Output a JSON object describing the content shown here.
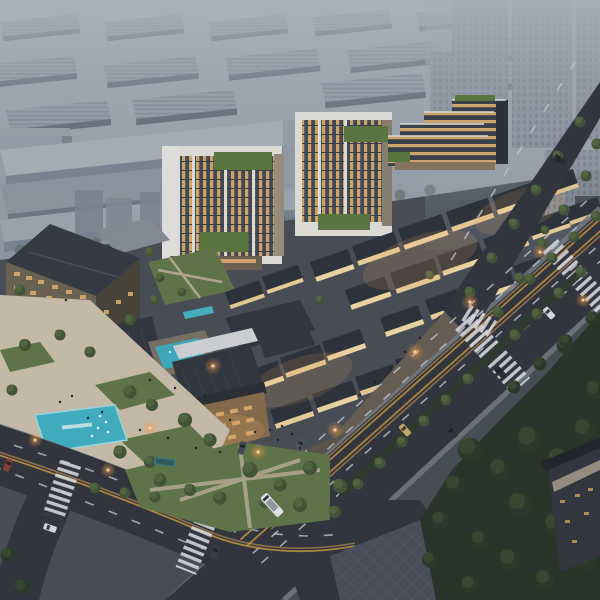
{
  "scene": {
    "type": "architectural-aerial-rendering",
    "time_of_day": "dusk",
    "description": "Aerial dusk rendering of a mixed-use development: two lit mid-rise office towers with rooftop gardens, a terraced office building, a hotel block, a low-rise retail village with dark pitched roofs and warmly lit walls, a cultural center with a teal courtyard pool, a public plaza with a cyan reflecting pool, tree-lined avenues with crosswalks, buses and cars, a dark park, hazy industrial sheds and distant residential towers in the background",
    "features": [
      "industrial warehouse district in haze (background left)",
      "high-rise residential cluster in haze (background right)",
      "two office towers with amber windows and green roof terraces",
      "stepped terraced office building with warm horizontal bands",
      "hotel block with dark pitched roof",
      "retail village of small dark-roofed buildings with lit facades",
      "cultural center with large dark roofs, white walls, wood facade and teal courtyard pool",
      "plaza with cyan reflecting pool, lawns, trees and pedestrians",
      "main diagonal avenue with tree median, lane dashes and zebra crossings",
      "curved west road merging at an intersection",
      "branch road to the top right lined with trees",
      "white bus, teal bus, cars, red truck, street lamps",
      "dark park with dense trees and diamond-paved walk (bottom right)"
    ]
  },
  "palette": {
    "sky_top": "#adb4be",
    "sky_mid": "#8e97a3",
    "industrial_roof": "#96a0ab",
    "industrial_wall": "#6f7a87",
    "residential_far": "#8b919e",
    "tower_frame": "#e7e4de",
    "tower_window_lit": "#d7a96e",
    "tower_window_dark": "#474c55",
    "roof_garden": "#5d7a40",
    "terraced_band": "#d7ab6f",
    "hotel_roof": "#373b43",
    "hotel_wall": "#6e6554",
    "village_roof": "#2f333b",
    "village_wall_lit": "#f4dca6",
    "cultural_roof": "#34373f",
    "cultural_white": "#d8d9db",
    "wood_facade": "#8a6e4c",
    "pool_teal": "#41b3c5",
    "courtyard_teal": "#3fb0c2",
    "plaza": "#cfc2ae",
    "lawn": "#63774a",
    "asphalt": "#33363e",
    "road_marking": "#c9cdd3",
    "center_line": "#c29540",
    "park_dark": "#2a3529",
    "pavement_se": "#4b4f5b",
    "lamp_glow": "#ffb763",
    "vehicle_white": "#e9ebee",
    "bus_teal": "#3f7d7a",
    "truck_red": "#8a4034",
    "taxi_yellow": "#cdb06a"
  }
}
